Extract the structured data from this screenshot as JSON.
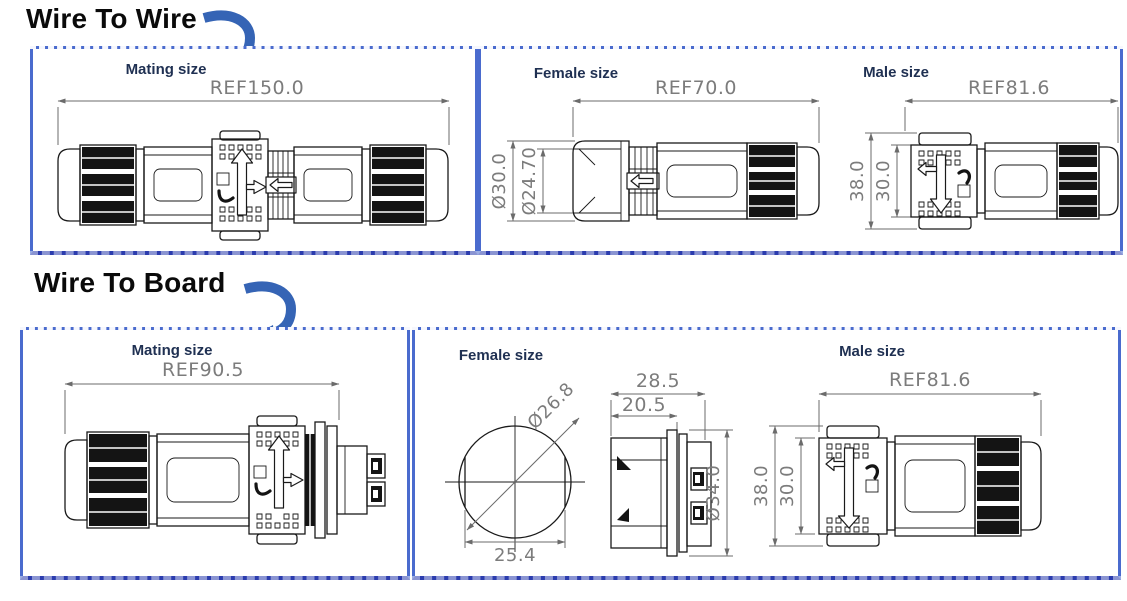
{
  "colors": {
    "panel_border": "#4a6bce",
    "panel_border_bottom": "#2b3cae",
    "accent_arrow": "#3564b5",
    "label_text": "#1f3052",
    "dimension_text": "#7c7c7c",
    "drawing_line": "#1a1a1a"
  },
  "wire_to_wire": {
    "title": "Wire To Wire",
    "mating": {
      "label": "Mating size",
      "ref": "REF150.0"
    },
    "female": {
      "label": "Female size",
      "ref": "REF70.0",
      "outer_dia": "Ø30.0",
      "inner_dia": "Ø24.70"
    },
    "male": {
      "label": "Male size",
      "ref": "REF81.6",
      "outer_height": "38.0",
      "inner_height": "30.0"
    }
  },
  "wire_to_board": {
    "title": "Wire To Board",
    "mating": {
      "label": "Mating size",
      "ref": "REF90.5"
    },
    "female": {
      "label": "Female size",
      "face_dia": "Ø26.8",
      "face_width": "25.4",
      "total_length": "28.5",
      "front_length": "20.5",
      "body_dia": "Ø34.0"
    },
    "male": {
      "label": "Male size",
      "ref": "REF81.6",
      "outer_height": "38.0",
      "inner_height": "30.0"
    }
  }
}
